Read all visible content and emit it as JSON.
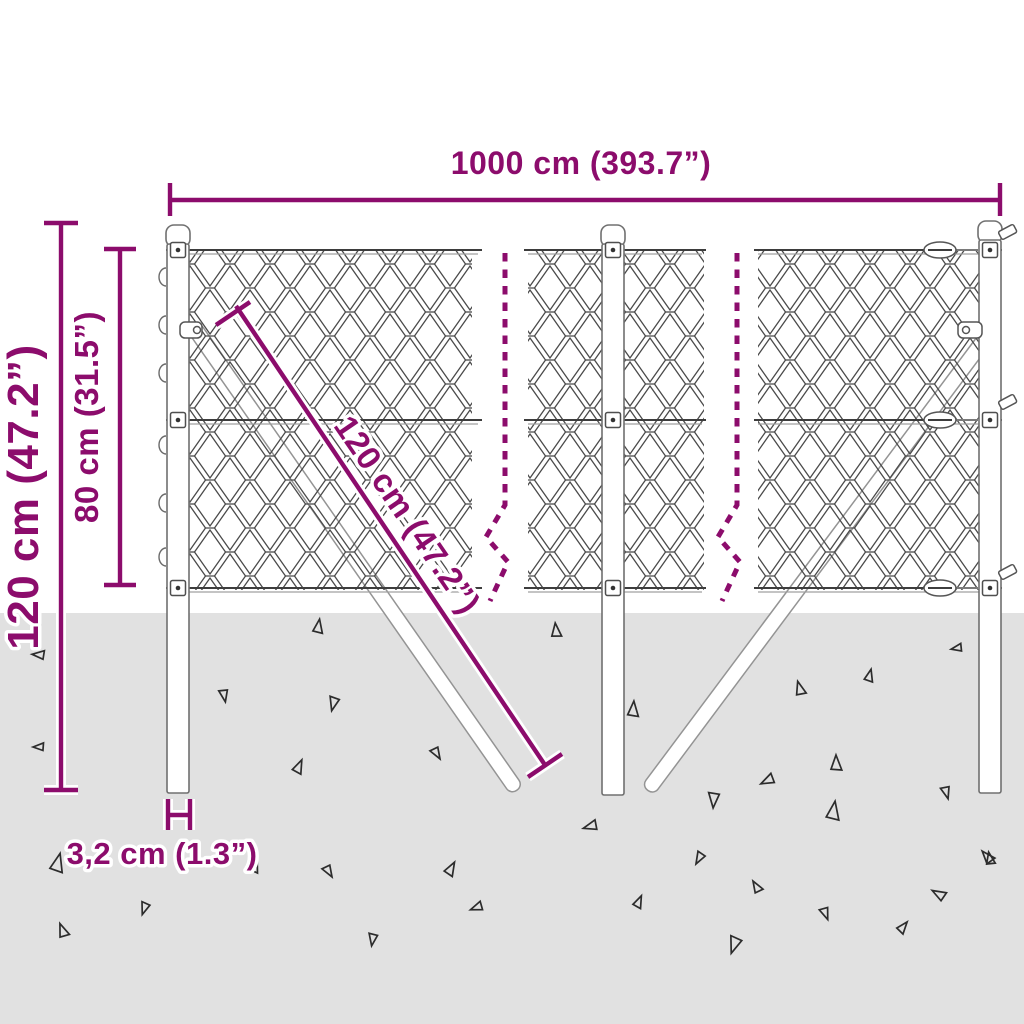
{
  "diagram": {
    "type": "product-dimension-diagram",
    "subject": "chain-link-fence-kit-with-posts-and-braces",
    "dimensions": {
      "width": "1000 cm (393.7”)",
      "total_height": "120 cm (47.2”)",
      "fence_height": "80 cm (31.5”)",
      "brace_length": "120 cm (47.2”)",
      "post_diameter": "3,2 cm (1.3”)"
    },
    "colors": {
      "accent": "#8c0c6c",
      "ground": "#e1e1e1",
      "mesh_line": "#4a4a4a",
      "structure_line": "#707070",
      "background": "#ffffff",
      "triangle_line": "#2c2c2c"
    }
  },
  "ground_triangles": [
    [
      318,
      628,
      9,
      10
    ],
    [
      556,
      632,
      9,
      -5
    ],
    [
      40,
      655,
      8,
      -85
    ],
    [
      869,
      677,
      8,
      15
    ],
    [
      958,
      648,
      7,
      -100
    ],
    [
      800,
      690,
      9,
      -15
    ],
    [
      224,
      694,
      8,
      170
    ],
    [
      334,
      702,
      9,
      195
    ],
    [
      633,
      711,
      10,
      5
    ],
    [
      40,
      747,
      7,
      -90
    ],
    [
      436,
      752,
      8,
      150
    ],
    [
      298,
      768,
      9,
      25
    ],
    [
      836,
      765,
      10,
      0
    ],
    [
      769,
      780,
      9,
      245
    ],
    [
      946,
      791,
      8,
      165
    ],
    [
      714,
      798,
      10,
      185
    ],
    [
      592,
      826,
      9,
      255
    ],
    [
      833,
      813,
      12,
      10
    ],
    [
      988,
      858,
      9,
      -40
    ],
    [
      57,
      865,
      12,
      15
    ],
    [
      253,
      865,
      12,
      20
    ],
    [
      328,
      870,
      8,
      150
    ],
    [
      450,
      870,
      9,
      30
    ],
    [
      700,
      857,
      8,
      210
    ],
    [
      990,
      860,
      8,
      -10
    ],
    [
      145,
      907,
      8,
      200
    ],
    [
      63,
      932,
      9,
      -20
    ],
    [
      478,
      907,
      8,
      250
    ],
    [
      735,
      943,
      11,
      200
    ],
    [
      825,
      912,
      8,
      160
    ],
    [
      902,
      928,
      8,
      40
    ],
    [
      940,
      895,
      9,
      -60
    ],
    [
      373,
      938,
      8,
      190
    ],
    [
      757,
      888,
      8,
      -30
    ],
    [
      638,
      903,
      8,
      25
    ]
  ]
}
